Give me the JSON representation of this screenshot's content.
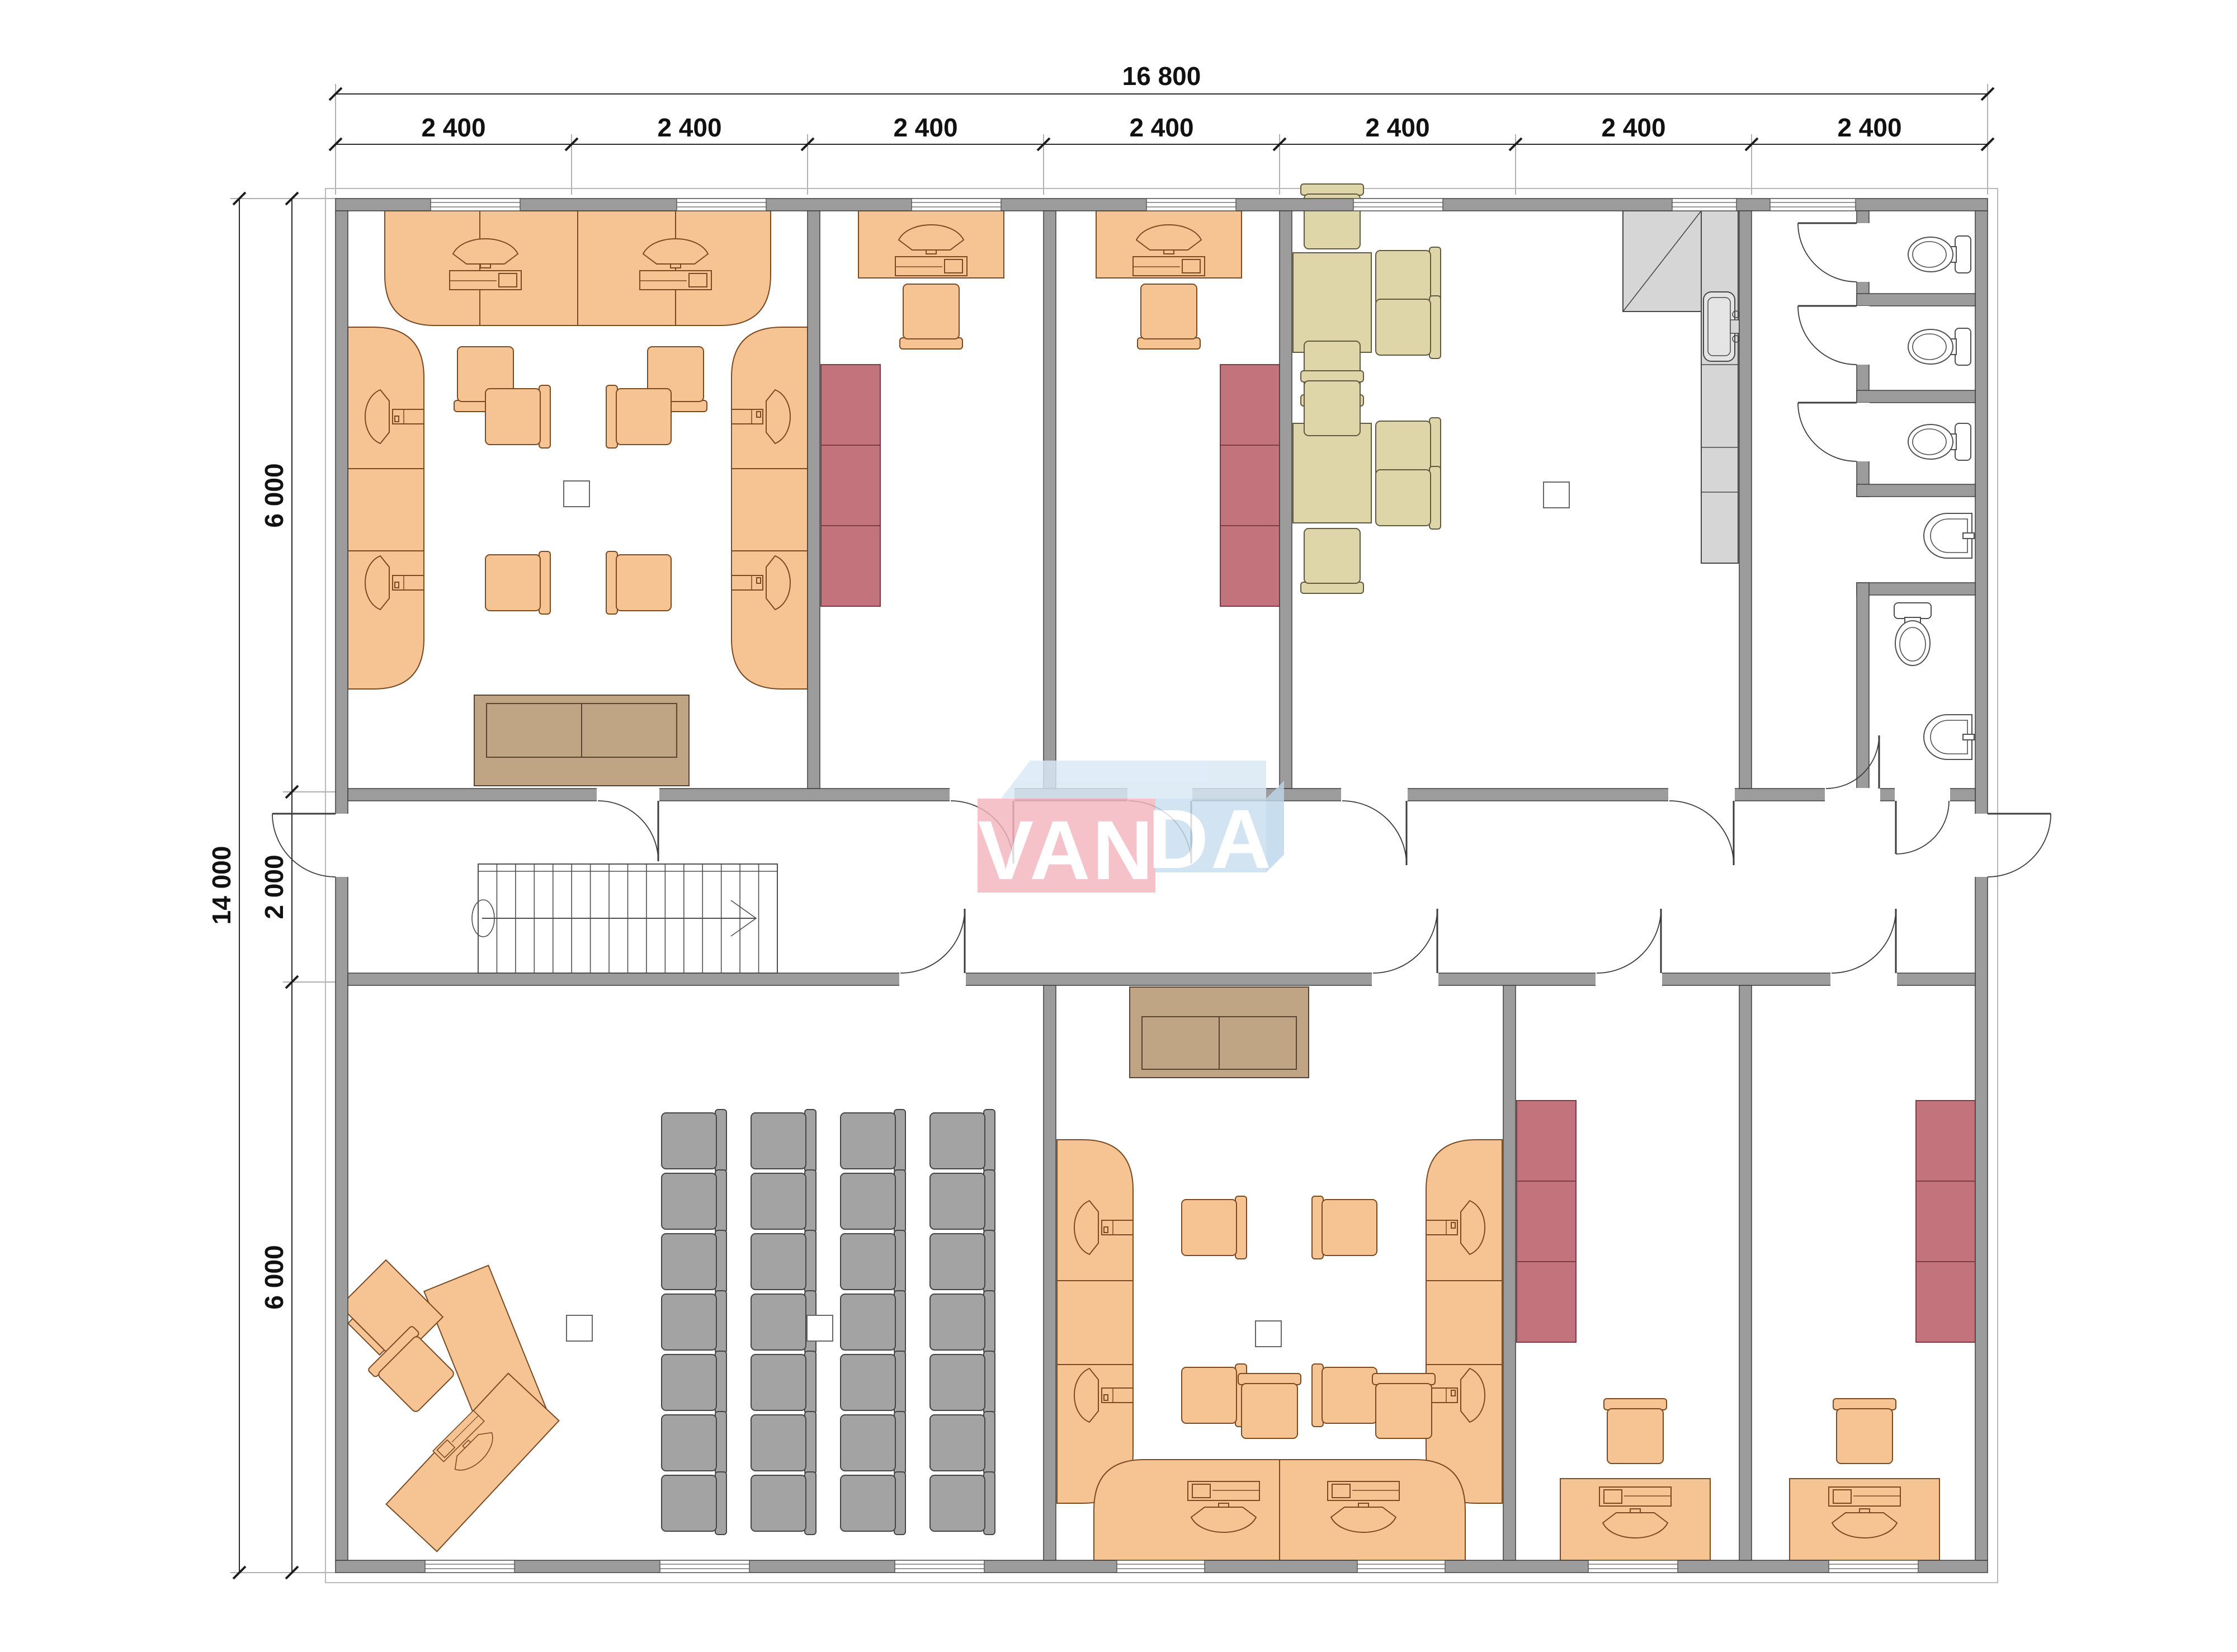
{
  "page": {
    "background": "#ffffff",
    "kind": "architectural-floor-plan"
  },
  "logo": {
    "full": "VANDA",
    "left_text": "VAN",
    "right_text": "DA",
    "pink": "#f3b5be",
    "blue": "#c9def0",
    "blue_top": "#d9e8f5",
    "blue_side": "#bdd6ea"
  },
  "dimensions": {
    "top_total": "16 800",
    "top_segments": [
      "2 400",
      "2 400",
      "2 400",
      "2 400",
      "2 400",
      "2 400",
      "2 400"
    ],
    "left_total": "14 000",
    "left_top": "6 000",
    "left_middle": "2 000",
    "left_bottom": "6 000"
  },
  "palette": {
    "wall": "#9c9c9c",
    "wall_edge": "#3f3f3f",
    "desk": "#f6c493",
    "desk_edge": "#7a4a23",
    "cabinet": "#c3737b",
    "cabinet_edge": "#7d3b43",
    "meeting": "#ded5a8",
    "meeting_edge": "#625a40",
    "sofa": "#c0a584",
    "sofa_edge": "#574433",
    "audience_chair": "#a3a3a3",
    "audience_chair_edge": "#454545",
    "kitchen": "#d6d6d6",
    "fixture_edge": "#4f4f4f"
  },
  "inventory": {
    "open_office_top": {
      "workstations": 6,
      "chairs": 6,
      "sofas": 1
    },
    "office_top_1": {
      "desks": 1,
      "chairs": 1,
      "cabinet_sections": 3
    },
    "office_top_2": {
      "desks": 1,
      "chairs": 1,
      "cabinet_sections": 3
    },
    "meeting_room": {
      "tables": 2,
      "chairs": 8,
      "kitchen_units": 1,
      "sinks": 1
    },
    "wc": {
      "stalls": 3,
      "toilets": 4,
      "sinks": 2
    },
    "training_room": {
      "chair_rows": 7,
      "chair_columns": 4,
      "chairs": 28,
      "reception_desks": 2
    },
    "open_office_bottom": {
      "workstations": 6,
      "chairs": 6,
      "sofas": 1
    },
    "office_bottom_1": {
      "desks": 1,
      "chairs": 1,
      "cabinet_sections": 3
    },
    "office_bottom_2": {
      "desks": 1,
      "chairs": 1,
      "cabinet_sections": 3
    },
    "stairs": {
      "flights": 1,
      "treads": 15
    }
  }
}
